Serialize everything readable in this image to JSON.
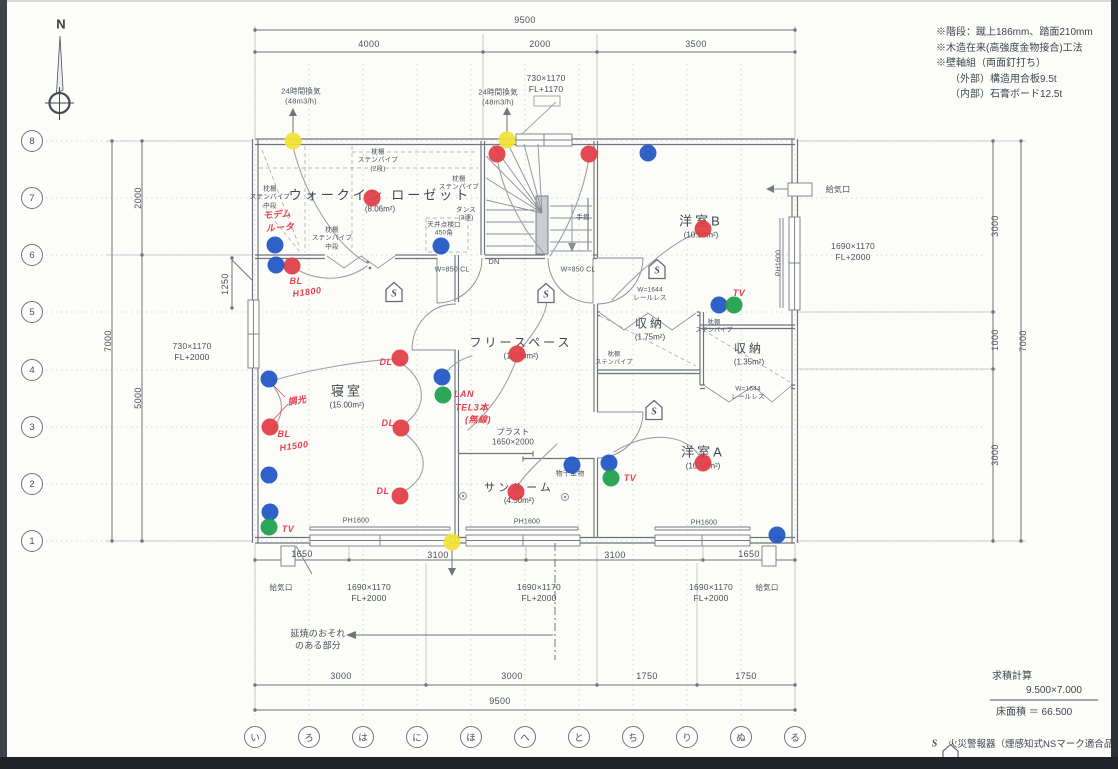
{
  "colors": {
    "red": "#e23c44",
    "blue": "#1f55c4",
    "green": "#1ca04a",
    "yellow": "#f1e235",
    "hand_red": "#e8414f",
    "ink": "#49505c",
    "line": "#7c828c"
  },
  "compass": {
    "label": "N"
  },
  "notes": [
    {
      "t": "※階段：蹴上186mm、踏面210mm"
    },
    {
      "t": "※木造在来(高強度金物接合)工法"
    },
    {
      "t": "※壁軸組（両面釘打ち）"
    },
    {
      "t": "（外部）構造用合板9.5t",
      "pad": 14
    },
    {
      "t": "（内部）石膏ボード12.5t",
      "pad": 14
    }
  ],
  "grid": {
    "rows": [
      {
        "label": "8",
        "x": 32,
        "y": 141
      },
      {
        "label": "7",
        "x": 32,
        "y": 198
      },
      {
        "label": "6",
        "x": 32,
        "y": 255
      },
      {
        "label": "5",
        "x": 32,
        "y": 312
      },
      {
        "label": "4",
        "x": 32,
        "y": 370
      },
      {
        "label": "3",
        "x": 32,
        "y": 427
      },
      {
        "label": "2",
        "x": 32,
        "y": 484
      },
      {
        "label": "1",
        "x": 32,
        "y": 541
      }
    ],
    "cols": [
      {
        "label": "い",
        "x": 255,
        "y": 737
      },
      {
        "label": "ろ",
        "x": 309,
        "y": 737
      },
      {
        "label": "は",
        "x": 363,
        "y": 737
      },
      {
        "label": "に",
        "x": 417,
        "y": 737
      },
      {
        "label": "ほ",
        "x": 471,
        "y": 737
      },
      {
        "label": "へ",
        "x": 525,
        "y": 737
      },
      {
        "label": "と",
        "x": 579,
        "y": 737
      },
      {
        "label": "ち",
        "x": 633,
        "y": 737
      },
      {
        "label": "り",
        "x": 687,
        "y": 737
      },
      {
        "label": "ぬ",
        "x": 741,
        "y": 737
      },
      {
        "label": "る",
        "x": 795,
        "y": 737
      }
    ]
  },
  "dim_labels": [
    {
      "t": "9500",
      "x": 525,
      "y": 21
    },
    {
      "t": "4000",
      "x": 369,
      "y": 45
    },
    {
      "t": "2000",
      "x": 540,
      "y": 45
    },
    {
      "t": "3500",
      "x": 696,
      "y": 45
    },
    {
      "t": "2000",
      "x": 139,
      "y": 198,
      "rot": -90
    },
    {
      "t": "7000",
      "x": 109,
      "y": 341,
      "rot": -90
    },
    {
      "t": "5000",
      "x": 139,
      "y": 398,
      "rot": -90
    },
    {
      "t": "1250",
      "x": 226,
      "y": 284,
      "rot": -90
    },
    {
      "t": "3000",
      "x": 996,
      "y": 226,
      "rot": -90
    },
    {
      "t": "1000",
      "x": 996,
      "y": 340,
      "rot": -90
    },
    {
      "t": "3000",
      "x": 996,
      "y": 455,
      "rot": -90
    },
    {
      "t": "7000",
      "x": 1024,
      "y": 341,
      "rot": -90
    },
    {
      "t": "1650",
      "x": 302,
      "y": 555
    },
    {
      "t": "3100",
      "x": 438,
      "y": 556
    },
    {
      "t": "3100",
      "x": 615,
      "y": 556
    },
    {
      "t": "1650",
      "x": 749,
      "y": 555
    },
    {
      "t": "3000",
      "x": 341,
      "y": 677
    },
    {
      "t": "3000",
      "x": 512,
      "y": 677
    },
    {
      "t": "1750",
      "x": 647,
      "y": 677
    },
    {
      "t": "1750",
      "x": 746,
      "y": 677
    },
    {
      "t": "9500",
      "x": 500,
      "y": 702
    }
  ],
  "plan_labels": [
    {
      "t": "24時間換気\n(48m3/h)",
      "x": 301,
      "y": 96
    },
    {
      "t": "24時間換気\n(48m3/h)",
      "x": 498,
      "y": 97
    },
    {
      "t": "730×1170\nFL+1170",
      "x": 546,
      "y": 84,
      "fs": 8.5
    },
    {
      "t": "枕棚\nステンパイプ\n(2段)",
      "x": 378,
      "y": 161,
      "fs": 6.5
    },
    {
      "t": "枕棚\nステンパイプ\n中段",
      "x": 270,
      "y": 198,
      "fs": 6.5
    },
    {
      "t": "枕棚\nステンパイプ\n中段",
      "x": 332,
      "y": 239,
      "fs": 6.5
    },
    {
      "t": "枕棚\nステンパイプ",
      "x": 459,
      "y": 184,
      "fs": 6.5
    },
    {
      "t": "タンス\n(3連)",
      "x": 466,
      "y": 215,
      "fs": 6.5
    },
    {
      "t": "天井点検口\n450角",
      "x": 444,
      "y": 230,
      "fs": 6.5
    },
    {
      "t": "W=850 CL",
      "x": 452,
      "y": 270,
      "fs": 7
    },
    {
      "t": "W=850 CL",
      "x": 578,
      "y": 270,
      "fs": 7
    },
    {
      "t": "DN",
      "x": 494,
      "y": 262,
      "fs": 7.5
    },
    {
      "t": "手摺",
      "x": 583,
      "y": 218,
      "fs": 6.5
    },
    {
      "t": "W=1644\nレールレス",
      "x": 650,
      "y": 295,
      "fs": 6.5
    },
    {
      "t": "W=1644\nレールレス",
      "x": 748,
      "y": 394,
      "fs": 6.5
    },
    {
      "t": "枕棚\nステンパイプ",
      "x": 614,
      "y": 360,
      "fs": 6
    },
    {
      "t": "枕棚\nステンパイプ",
      "x": 714,
      "y": 328,
      "fs": 6
    },
    {
      "t": "給気口",
      "x": 838,
      "y": 190,
      "fs": 8
    },
    {
      "t": "給気口",
      "x": 281,
      "y": 588,
      "fs": 7.5
    },
    {
      "t": "給気口",
      "x": 767,
      "y": 588,
      "fs": 7.5
    },
    {
      "t": "1690×1170\nFL+2000",
      "x": 853,
      "y": 252,
      "fs": 8.5
    },
    {
      "t": "730×1170\nFL+2000",
      "x": 192,
      "y": 352,
      "fs": 8.5
    },
    {
      "t": "1690×1170\nFL+2000",
      "x": 369,
      "y": 593,
      "fs": 8.5
    },
    {
      "t": "1690×1170\nFL+2000",
      "x": 539,
      "y": 593,
      "fs": 8.5
    },
    {
      "t": "1690×1170\nFL+2000",
      "x": 711,
      "y": 593,
      "fs": 8.5
    },
    {
      "t": "PH1600",
      "x": 779,
      "y": 263,
      "fs": 7,
      "rot": -90
    },
    {
      "t": "PH1600",
      "x": 356,
      "y": 521,
      "fs": 7
    },
    {
      "t": "PH1600",
      "x": 527,
      "y": 522,
      "fs": 7
    },
    {
      "t": "PH1600",
      "x": 704,
      "y": 523,
      "fs": 7
    },
    {
      "t": "プラスト\n1650×2000",
      "x": 513,
      "y": 438,
      "fs": 8
    },
    {
      "t": "物干金物",
      "x": 570,
      "y": 474,
      "fs": 7
    },
    {
      "t": "延焼のおそれ\nのある部分",
      "x": 318,
      "y": 640,
      "fs": 9
    }
  ],
  "rooms": [
    {
      "name": "ウォークイン ローゼット",
      "area": "(8.06m²)",
      "x": 380,
      "y": 199,
      "fs": 13
    },
    {
      "name": "寝室",
      "area": "(15.00m²)",
      "x": 347,
      "y": 395,
      "fs": 13
    },
    {
      "name": "フリースペース",
      "area": "(10.00m²)",
      "x": 521,
      "y": 347,
      "fs": 12
    },
    {
      "name": "収納",
      "area": "(1.75m²)",
      "x": 650,
      "y": 328,
      "fs": 12
    },
    {
      "name": "収納",
      "area": "(1.35m²)",
      "x": 749,
      "y": 353,
      "fs": 12
    },
    {
      "name": "洋室B",
      "area": "(10.50m²)",
      "x": 701,
      "y": 225,
      "fs": 13
    },
    {
      "name": "洋室A",
      "area": "(10.50m²)",
      "x": 703,
      "y": 456,
      "fs": 13
    },
    {
      "name": "サンルーム",
      "area": "(4.50m²)",
      "x": 519,
      "y": 492,
      "fs": 11
    }
  ],
  "hand_notes": [
    {
      "t": "モデム",
      "x": 277,
      "y": 214,
      "rot": -4
    },
    {
      "t": "ルータ",
      "x": 280,
      "y": 227,
      "rot": -4
    },
    {
      "t": "BL",
      "x": 296,
      "y": 281
    },
    {
      "t": "H1800",
      "x": 307,
      "y": 292,
      "rot": -8
    },
    {
      "t": "調光",
      "x": 297,
      "y": 400,
      "rot": -10
    },
    {
      "t": "BL",
      "x": 284,
      "y": 434
    },
    {
      "t": "H1500",
      "x": 294,
      "y": 446,
      "rot": -8
    },
    {
      "t": "DL",
      "x": 386,
      "y": 362
    },
    {
      "t": "DL",
      "x": 388,
      "y": 423
    },
    {
      "t": "DL",
      "x": 383,
      "y": 491
    },
    {
      "t": "LAN",
      "x": 464,
      "y": 394
    },
    {
      "t": "TEL3本",
      "x": 472,
      "y": 407
    },
    {
      "t": "(無線)",
      "x": 478,
      "y": 419
    },
    {
      "t": "TV",
      "x": 288,
      "y": 529
    },
    {
      "t": "TV",
      "x": 739,
      "y": 293
    },
    {
      "t": "TV",
      "x": 630,
      "y": 478
    }
  ],
  "dots": {
    "yellow": [
      {
        "x": 293,
        "y": 141
      },
      {
        "x": 507,
        "y": 140
      },
      {
        "x": 452,
        "y": 542
      }
    ],
    "red": [
      {
        "x": 372,
        "y": 198
      },
      {
        "x": 497,
        "y": 154
      },
      {
        "x": 589,
        "y": 154
      },
      {
        "x": 292,
        "y": 266
      },
      {
        "x": 703,
        "y": 229
      },
      {
        "x": 270,
        "y": 427
      },
      {
        "x": 400,
        "y": 358
      },
      {
        "x": 401,
        "y": 428
      },
      {
        "x": 400,
        "y": 496
      },
      {
        "x": 517,
        "y": 354
      },
      {
        "x": 516,
        "y": 492
      },
      {
        "x": 703,
        "y": 463
      }
    ],
    "blue": [
      {
        "x": 275,
        "y": 245
      },
      {
        "x": 276,
        "y": 265
      },
      {
        "x": 441,
        "y": 246
      },
      {
        "x": 648,
        "y": 153
      },
      {
        "x": 269,
        "y": 379
      },
      {
        "x": 269,
        "y": 475
      },
      {
        "x": 270,
        "y": 512
      },
      {
        "x": 442,
        "y": 377
      },
      {
        "x": 572,
        "y": 465
      },
      {
        "x": 609,
        "y": 463
      },
      {
        "x": 719,
        "y": 305
      },
      {
        "x": 777,
        "y": 535
      }
    ],
    "green": [
      {
        "x": 269,
        "y": 527
      },
      {
        "x": 443,
        "y": 395
      },
      {
        "x": 611,
        "y": 478
      },
      {
        "x": 734,
        "y": 305
      }
    ]
  },
  "alarm": {
    "symbol": "S",
    "positions": [
      {
        "x": 394,
        "y": 292
      },
      {
        "x": 546,
        "y": 293
      },
      {
        "x": 657,
        "y": 269
      },
      {
        "x": 654,
        "y": 410
      }
    ]
  },
  "legend": {
    "text": "火災警報器（煙感知式NSマーク適合品）"
  },
  "calc": {
    "title": "求積計算",
    "formula": "9.500×7.000",
    "result": "床面積 ＝ 66.500"
  }
}
